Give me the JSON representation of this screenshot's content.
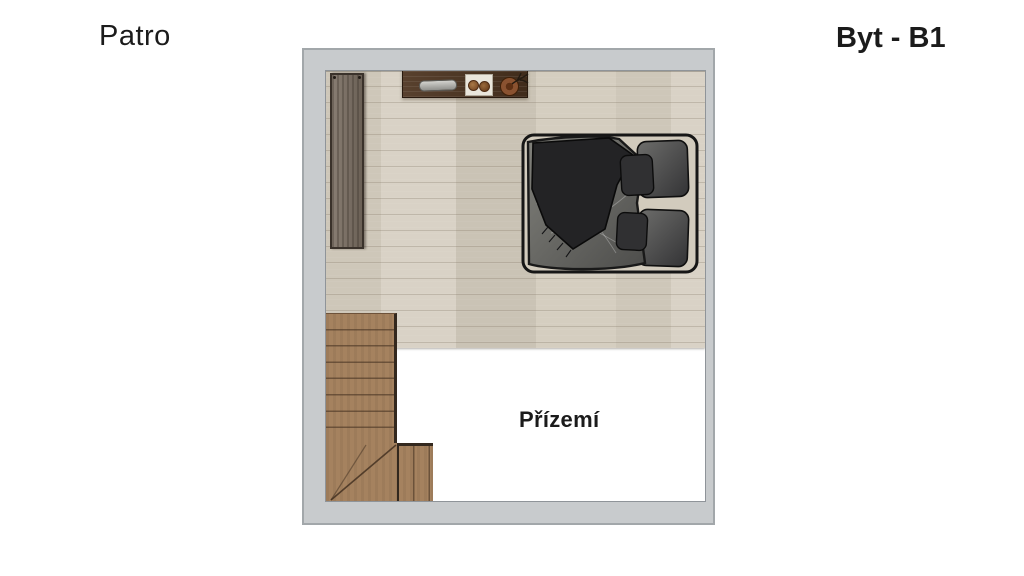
{
  "labels": {
    "floor_title": "Patro",
    "apartment_title": "Byt - B1",
    "void_label": "Přízemí"
  },
  "plan": {
    "type": "apartment-floor-plan",
    "level_shown": "Patro",
    "apartment": "Byt - B1",
    "open_void_to": "Přízemí",
    "furniture": [
      {
        "name": "double-bed",
        "position": "center-right, headboard on right wall"
      },
      {
        "name": "wardrobe",
        "position": "upper left wall"
      },
      {
        "name": "wall-shelf-with-decor",
        "position": "top wall"
      },
      {
        "name": "staircase-with-winders",
        "position": "bottom left corner"
      }
    ]
  },
  "colors": {
    "page-bg": "#ffffff",
    "text-color": "#1b1b1b",
    "wall-gray": "#c8cbcd",
    "wall-outline": "#a2a7aa",
    "floor-wood": "#d5cec0",
    "stairs-wood": "#a5825f",
    "shelf-wood": "#4e3521",
    "wardrobe-wood": "#7a6e62",
    "bed-frame": "#d2cbbd",
    "bed-duvet": "#6f6f6b",
    "bed-blanket": "#232325"
  }
}
